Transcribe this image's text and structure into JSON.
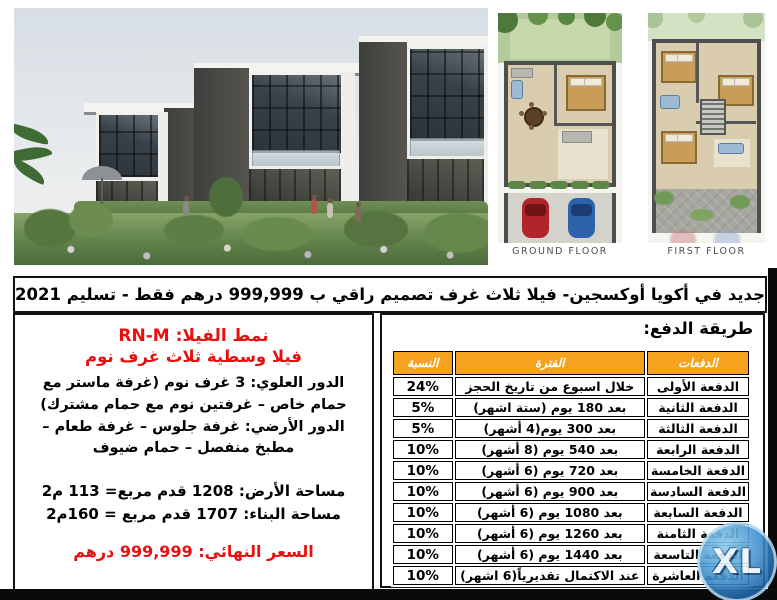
{
  "headline": "جديد في أكويا أوكسجين- فيلا ثلاث غرف تصميم راقي ب 999,999 درهم فقط - تسليم 2021",
  "floor_plans": {
    "ground_label": "GROUND FLOOR",
    "first_label": "FIRST FLOOR"
  },
  "villa_details": {
    "type_line": "نمط الفيلا: RN-M",
    "subtitle": "فيلا وسطية ثلاث غرف نوم",
    "upper_floor_label": "الدور العلوي:",
    "upper_floor_text": " 3 غرف نوم (غرفة ماستر مع حمام خاص – غرفتين نوم مع حمام مشترك)",
    "ground_floor_label": "الدور الأرضي:",
    "ground_floor_text": " غرفة جلوس – غرفة طعام – مطبخ منفصل – حمام ضيوف",
    "land_area": "مساحة الأرض: 1208 قدم مربع= 113 م2",
    "built_area": "مساحة البناء: 1707 قدم مربع = 160م2",
    "final_price": "السعر النهائي: 999,999 درهم"
  },
  "payment": {
    "title": "طريقة الدفع:",
    "columns": [
      "الدفعات",
      "الفترة",
      "النسبة"
    ],
    "header_bg": "#f5a21e",
    "rows": [
      [
        "الدفعة الأولى",
        "خلال اسبوع من تاريخ الحجز",
        "24%"
      ],
      [
        "الدفعة الثانية",
        "بعد 180 يوم (ستة اشهر)",
        "5%"
      ],
      [
        "الدفعة الثالثة",
        "بعد 300 يوم(4 أشهر)",
        "5%"
      ],
      [
        "الدفعة الرابعة",
        "بعد 540 يوم (8 أشهر)",
        "10%"
      ],
      [
        "الدفعة الخامسة",
        "بعد 720 يوم (6 أشهر)",
        "10%"
      ],
      [
        "الدفعة السادسة",
        "بعد 900 يوم (6 أشهر)",
        "10%"
      ],
      [
        "الدفعة السابعة",
        "بعد 1080 يوم (6 أشهر)",
        "10%"
      ],
      [
        "الدفعة الثامنة",
        "بعد 1260 يوم (6 أشهر)",
        "10%"
      ],
      [
        "الدفعة التاسعة",
        "بعد 1440 يوم (6 أشهر)",
        "10%"
      ],
      [
        "الدفعة العاشرة",
        "عند الاكتمال تقديرياً(6 اشهر)",
        "10%"
      ]
    ]
  },
  "watermark": {
    "label": "XL"
  }
}
